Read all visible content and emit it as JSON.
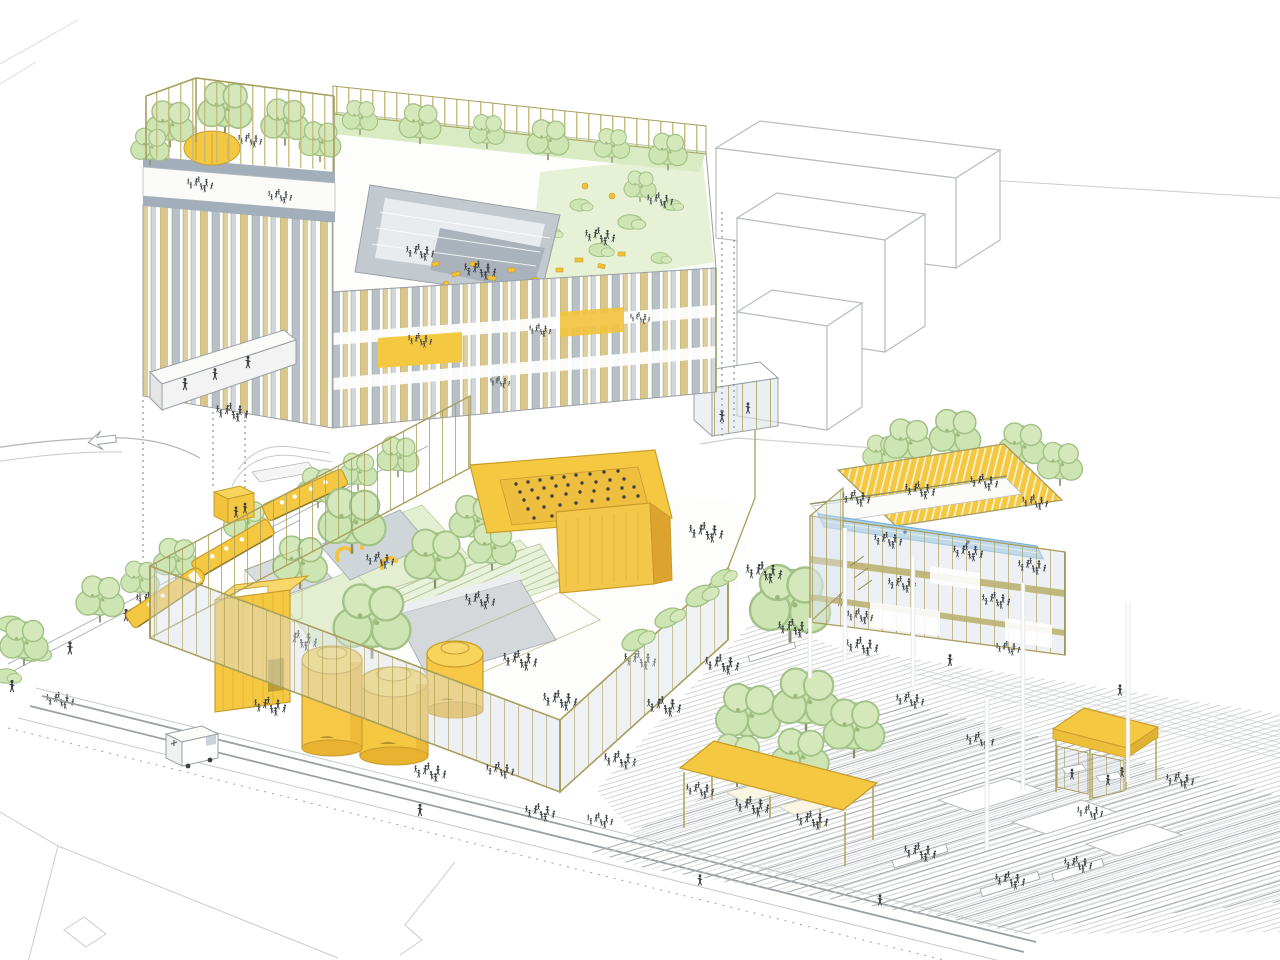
{
  "illustration": {
    "kind": "axonometric architectural site illustration",
    "colors": {
      "paper": "#FFFFFF",
      "accent_yellow": "#F5C842",
      "yellow_deep": "#E9B231",
      "yellow_outline": "#C79D2B",
      "tree_green": "#CDE5B2",
      "tree_outline": "#A3C287",
      "lawn_green": "#E3EFD0",
      "pool_blue": "#A8CFE9",
      "pool_outline": "#7FB3D6",
      "facade_tan": "#D8C68C",
      "facade_gray": "#B6C0CB",
      "glass_blue": "#D8E2EA",
      "glass_pane": "#C9D4DE",
      "frame_olive": "#A89F5E",
      "line_gray": "#9AA0A4",
      "ghost_line": "#B9BDBF",
      "figure_dark": "#3C4043",
      "concrete_gray": "#C6CDD3",
      "slab_gray": "#A2AEBA"
    },
    "elements": {
      "tower": "tower with rooftop pergola garden",
      "slab_building": "long slab building with roof garden and sunken court",
      "sky_bridge": "pedestrian sky bridge",
      "ghost_volumes": "three unbuilt white massing volumes",
      "tram": "yellow articulated tram",
      "tram_shelter": "yellow tram stop shelter",
      "street_trees": "street tree row",
      "glass_pavilion": "glass event pavilion with courtyard",
      "auditorium": "sunken yellow auditorium with crowd",
      "yellow_tower_room": "tall yellow stair box",
      "tanks": "three yellow storage tanks",
      "sports_building": "sports building with rooftop pool and yellow canopy",
      "plaza": "stepped public plaza",
      "market_canopy": "yellow market canopy",
      "kiosk": "yellow roofed kiosk",
      "delivery_van": "white delivery van",
      "people": "sketched pedestrians and cyclists"
    }
  }
}
